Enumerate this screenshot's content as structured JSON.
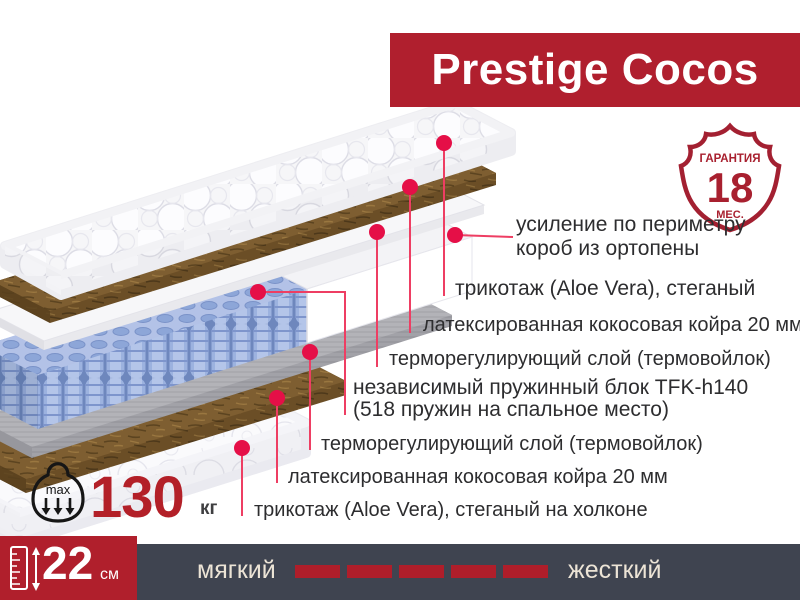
{
  "title": "Prestige Cocos",
  "badge": {
    "top": "ГАРАНТИЯ",
    "value": "18",
    "bottom": "МЕС."
  },
  "labels": [
    {
      "line1": "усиление по периметру",
      "line2": "короб из ортопены"
    },
    {
      "line1": "трикотаж (Aloe Vera), стеганый",
      "line2": ""
    },
    {
      "line1": "латексированная кокосовая койра 20 мм",
      "line2": ""
    },
    {
      "line1": "терморегулирующий слой (термовойлок)",
      "line2": ""
    },
    {
      "line1": "независимый пружинный блок TFK-h140",
      "line2": "(518 пружин на спальное место)"
    },
    {
      "line1": "терморегулирующий слой (термовойлок)",
      "line2": ""
    },
    {
      "line1": "латексированная кокосовая койра 20 мм",
      "line2": ""
    },
    {
      "line1": "трикотаж (Aloe Vera), стеганый на холконе",
      "line2": ""
    }
  ],
  "max_weight": {
    "value": "130",
    "unit": "кг",
    "icon_text": "max"
  },
  "mattress_height": {
    "value": "22",
    "unit": "см"
  },
  "firmness": {
    "left_label": "мягкий",
    "right_label": "жесткий",
    "dash_count": 5
  },
  "colors": {
    "banner_red": "#B01F2E",
    "block_red": "#B01F2C",
    "bar_dark": "#3F4450",
    "dash_red": "#AF1E2A",
    "cream_text": "#ECE4D6",
    "leader_line": "#EE3E63",
    "leader_dot": "#E50F47",
    "badge_red": "#A8202F",
    "weight_red": "#B32028"
  }
}
